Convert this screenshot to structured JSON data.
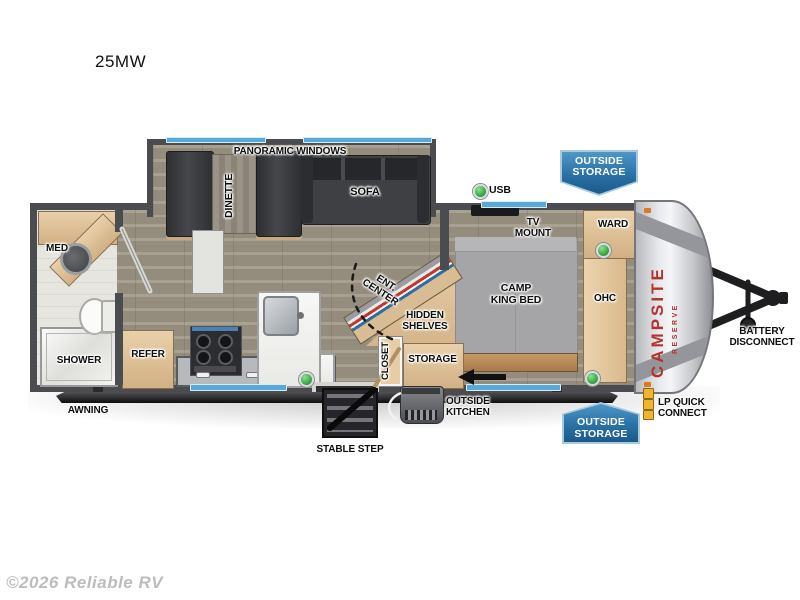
{
  "title": "25MW",
  "copyright": "©2026 Reliable RV",
  "brand": {
    "name": "CAMPSITE",
    "series": "RESERVE"
  },
  "labels": {
    "panoramic_windows": "PANORAMIC WINDOWS",
    "dinette": "DINETTE",
    "sofa": "SOFA",
    "usb": "USB",
    "tv_mount": "TV\nMOUNT",
    "ward": "WARD",
    "camp_king_bed": "CAMP\nKING BED",
    "ohc": "OHC",
    "med": "MED",
    "shower": "SHOWER",
    "refer": "REFER",
    "ent_center": "ENT.\nCENTER",
    "hidden_shelves": "HIDDEN\nSHELVES",
    "closet": "CLOSET",
    "storage": "STORAGE",
    "awning": "AWNING",
    "stable_step": "STABLE STEP",
    "outside_kitchen": "OUTSIDE\nKITCHEN",
    "outside_storage": "OUTSIDE\nSTORAGE",
    "lp_quick_connect": "LP QUICK\nCONNECT",
    "battery_disconnect": "BATTERY\nDISCONNECT"
  },
  "colors": {
    "badge_blue": "#2a71a5",
    "window_blue": "#57a9da",
    "wall_gray": "#4b4c50",
    "indicator_green": "#3fae4c",
    "brand_red": "#b5312c",
    "cabinet_wood": "#ddbf97"
  }
}
